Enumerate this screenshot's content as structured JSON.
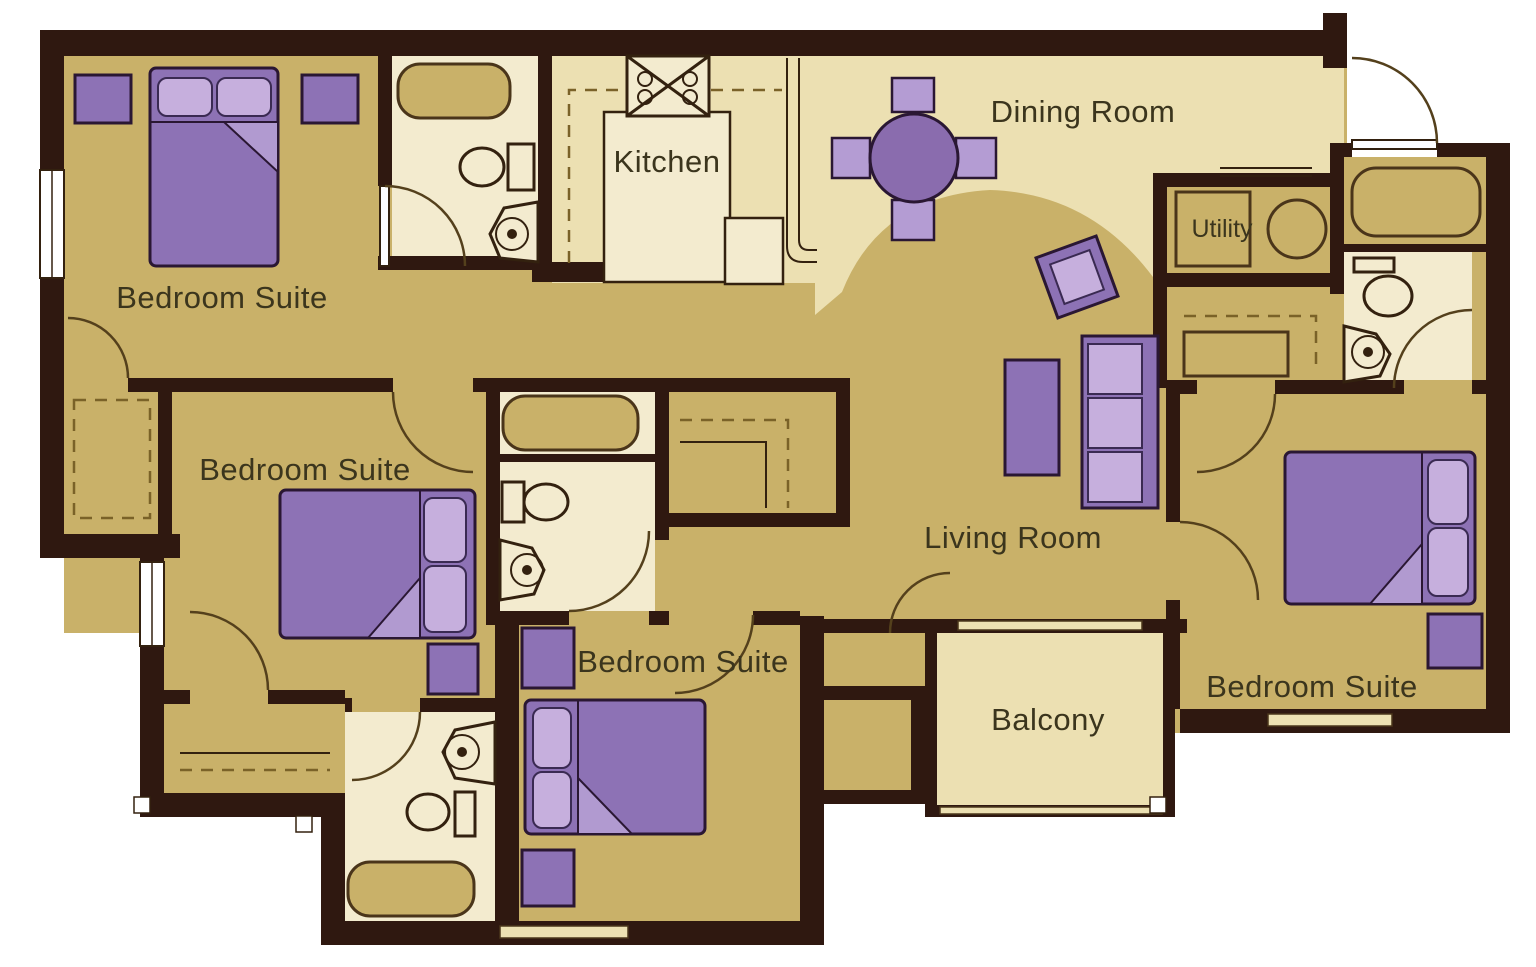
{
  "diagram_type": "apartment-floor-plan",
  "plan": {
    "rooms": {
      "bedroom_suite_top_left": {
        "label": "Bedroom Suite"
      },
      "kitchen": {
        "label": "Kitchen"
      },
      "dining_room": {
        "label": "Dining Room"
      },
      "utility": {
        "label": "Utility"
      },
      "bedroom_suite_mid_left": {
        "label": "Bedroom Suite"
      },
      "bedroom_suite_bottom": {
        "label": "Bedroom Suite"
      },
      "living_room": {
        "label": "Living Room"
      },
      "balcony": {
        "label": "Balcony"
      },
      "bedroom_suite_right": {
        "label": "Bedroom Suite"
      }
    },
    "fixture_icons": [
      "bed-icon",
      "pillow-icon",
      "nightstand-icon",
      "bathtub-icon",
      "toilet-icon",
      "sink-icon",
      "stove-icon",
      "kitchen-island-icon",
      "counter-icon",
      "refrigerator-icon",
      "dining-table-icon",
      "chair-icon",
      "sofa-icon",
      "coffee-table-icon",
      "end-table-icon",
      "washer-icon",
      "dryer-icon",
      "door-swing-icon",
      "window-icon",
      "closet-rod-icon",
      "sliding-door-icon"
    ],
    "palette": {
      "wall": "#2f1810",
      "floor_tan": "#c9b169",
      "floor_cream": "#ece0b2",
      "floor_bath": "#f3ebcf",
      "furniture_purple": "#8d72b5",
      "furniture_light_purple": "#c6afdd",
      "chair_purple": "#b49cd3",
      "line_brown": "#54401c",
      "label_text": "#3b351d",
      "background": "#ffffff"
    }
  }
}
